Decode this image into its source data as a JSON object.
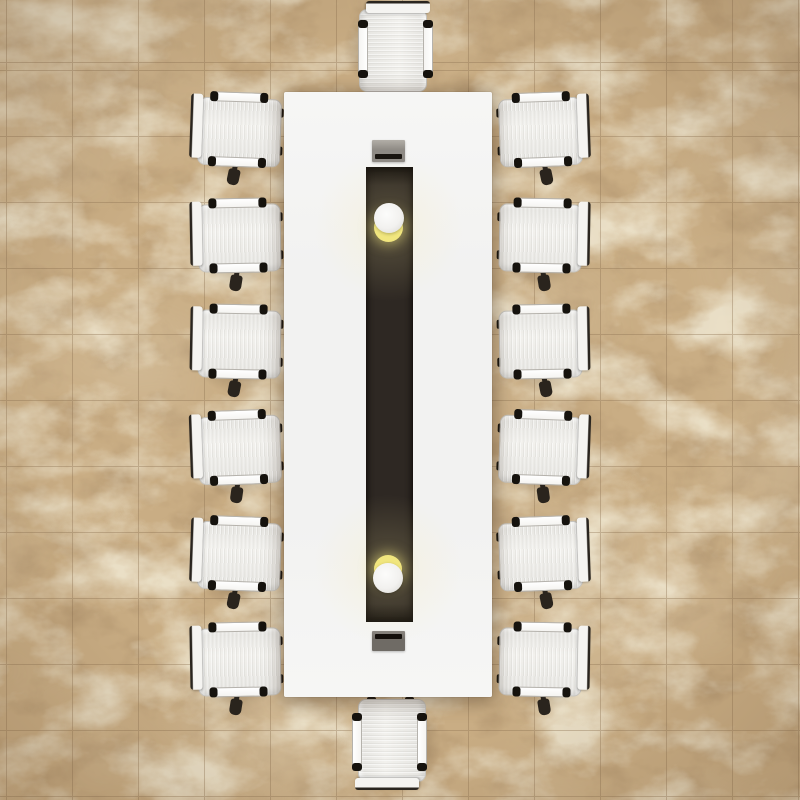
{
  "scene": {
    "description": "Top-down 3D render of a conference room: long white rectangular meeting table with a dark center runner, two round pendant lights, two grey cable trays, surrounded by fourteen white fabric office chairs (six per long side, one at each end) on a beige marble tile floor",
    "canvas": {
      "width": 800,
      "height": 800
    },
    "floor": {
      "base_color": "#c9ad84",
      "mottle_color": "#9c7f5c",
      "vein_color": "#f0e8d2",
      "patch_color": "#e9dfc8",
      "grout_color": "#8d7252",
      "tile_size": 66,
      "grout_offset_x": 6,
      "grout_offset_y": 63,
      "vignette_color": "rgba(92,66,40,0.24)"
    },
    "table": {
      "x": 284,
      "y": 92,
      "width": 208,
      "height": 605,
      "surface_color": "#f2f2f1",
      "surface_highlight": "#f6f6f5",
      "edge_shadow": "rgba(58,41,24,0.4)"
    },
    "runner": {
      "x": 366,
      "y": 167,
      "width": 47,
      "height": 455,
      "color": "#2e2823",
      "edge_color": "#14100c"
    },
    "cable_trays": [
      {
        "id": "top",
        "x": 372,
        "y": 140,
        "width": 33,
        "height": 22,
        "body_top": "#b2aea7",
        "body": "#8e8a84",
        "slot_color": "#191510",
        "slot_pos": "bottom"
      },
      {
        "id": "bottom",
        "x": 372,
        "y": 631,
        "width": 33,
        "height": 20,
        "body_top": "#8a8680",
        "body": "#6f6b65",
        "slot_color": "#130f0b",
        "slot_pos": "top"
      }
    ],
    "lights": [
      {
        "id": "top",
        "bulb_cx": 388.5,
        "bulb_cy": 218,
        "bulb_r": 15,
        "glow_cx": 388.5,
        "glow_cy": 227,
        "glow_r": 14.5,
        "halo_r": 80
      },
      {
        "id": "bottom",
        "bulb_cx": 388,
        "bulb_cy": 578,
        "bulb_r": 15,
        "glow_cx": 388,
        "glow_cy": 569,
        "glow_r": 14,
        "halo_r": 80
      }
    ],
    "light_style": {
      "bulb_color": "#f2f1ef",
      "bulb_highlight": "#fcfcfb",
      "glow_color": "#f1e67e",
      "halo_color": "rgba(248,234,160,0.22)"
    },
    "chair_style": {
      "frame_color": "#f5f4f1",
      "frame_edge": "#b5b2ac",
      "seat_color": "#e5e4e0",
      "seat_highlight": "#f2f1ed",
      "seat_edge": "#c6c4bf",
      "backrest_edge": "#2a251f",
      "tip_color": "#16130e",
      "caster_color": "#2a241d",
      "shadow_color": "rgba(71,52,31,0.38)"
    },
    "chair_count": 14,
    "chairs": [
      {
        "id": "left-1",
        "cx": 236,
        "cy": 132,
        "rot": 2,
        "flip": false,
        "caster": true
      },
      {
        "id": "left-2",
        "cx": 236,
        "cy": 238,
        "rot": -1,
        "flip": false,
        "caster": true
      },
      {
        "id": "left-3",
        "cx": 236,
        "cy": 344,
        "rot": 1,
        "flip": false,
        "caster": true
      },
      {
        "id": "left-4",
        "cx": 236,
        "cy": 450,
        "rot": -2,
        "flip": false,
        "caster": true
      },
      {
        "id": "left-5",
        "cx": 236,
        "cy": 556,
        "rot": 2,
        "flip": false,
        "caster": true
      },
      {
        "id": "left-6",
        "cx": 236,
        "cy": 662,
        "rot": -1,
        "flip": false,
        "caster": true
      },
      {
        "id": "right-1",
        "cx": 544,
        "cy": 132,
        "rot": -2,
        "flip": true,
        "caster": true
      },
      {
        "id": "right-2",
        "cx": 544,
        "cy": 238,
        "rot": 1,
        "flip": true,
        "caster": true
      },
      {
        "id": "right-3",
        "cx": 544,
        "cy": 344,
        "rot": -1,
        "flip": true,
        "caster": true
      },
      {
        "id": "right-4",
        "cx": 544,
        "cy": 450,
        "rot": 2,
        "flip": true,
        "caster": true
      },
      {
        "id": "right-5",
        "cx": 544,
        "cy": 556,
        "rot": -2,
        "flip": true,
        "caster": true
      },
      {
        "id": "right-6",
        "cx": 544,
        "cy": 662,
        "rot": 1,
        "flip": true,
        "caster": true
      },
      {
        "id": "head",
        "cx": 393,
        "cy": 47,
        "rot": 90,
        "flip": false,
        "caster": false
      },
      {
        "id": "foot",
        "cx": 392,
        "cy": 744,
        "rot": -90,
        "flip": false,
        "caster": false
      }
    ]
  }
}
